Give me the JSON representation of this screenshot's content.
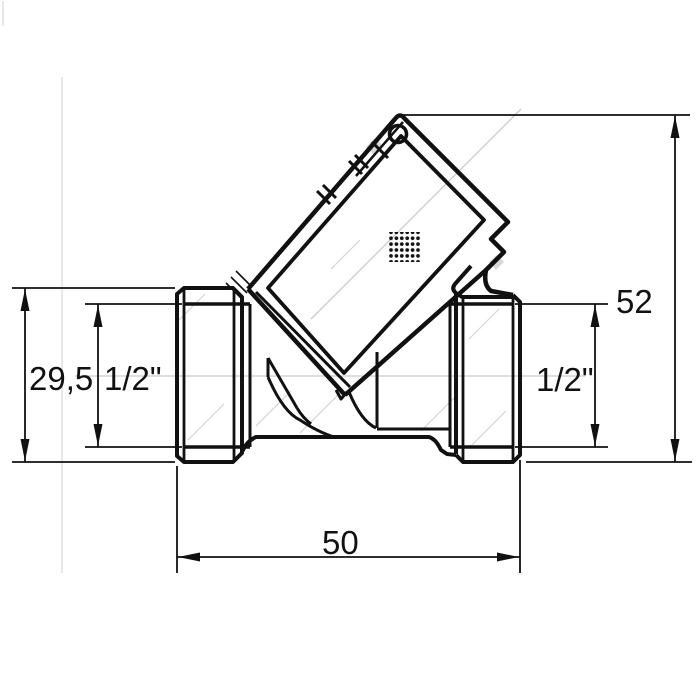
{
  "page": {
    "background": "#ffffff",
    "line_color": "#111111",
    "construction_color": "#c9c9c9",
    "artifact_color": "#dedede",
    "notch_color": "#d8d8d8"
  },
  "drawing": {
    "type": "technical-drawing",
    "subject": "angled-seat check valve / filter with diagonal cap, side view with dimensions",
    "dimensions": {
      "port_height": "29,5",
      "thread_left": "1/2\"",
      "thread_right": "1/2\"",
      "total_height": "52",
      "total_width": "50"
    }
  }
}
